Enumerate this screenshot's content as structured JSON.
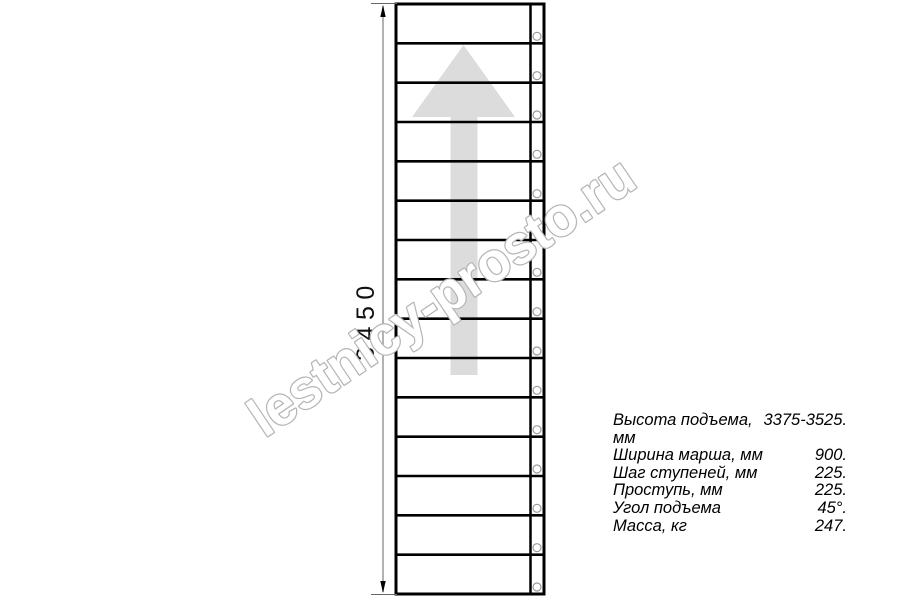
{
  "diagram": {
    "dimension": {
      "label": "3450"
    },
    "watermark": {
      "text": "lestnicy-prosto.ru"
    },
    "staircase": {
      "step_count": 15
    },
    "arrow": {
      "direction": "up"
    }
  },
  "specs": {
    "rows": [
      {
        "label": "Высота подъема, мм",
        "value": "3375-3525."
      },
      {
        "label": "Ширина марша, мм",
        "value": "900."
      },
      {
        "label": "Шаг ступеней, мм",
        "value": "225."
      },
      {
        "label": "Проступь, мм",
        "value": "225."
      },
      {
        "label": "Угол подъема",
        "value": "45°."
      },
      {
        "label": "Масса, кг",
        "value": "247."
      }
    ]
  },
  "colors": {
    "line": "#000000",
    "dimension_line": "#999999",
    "extension_line": "#666666",
    "arrow_fill": "#dcdcdc",
    "circle_stroke": "#9a9a9a",
    "watermark_stroke": "#b5b5b5",
    "watermark_fill": "#ffffff",
    "text": "#000000"
  }
}
